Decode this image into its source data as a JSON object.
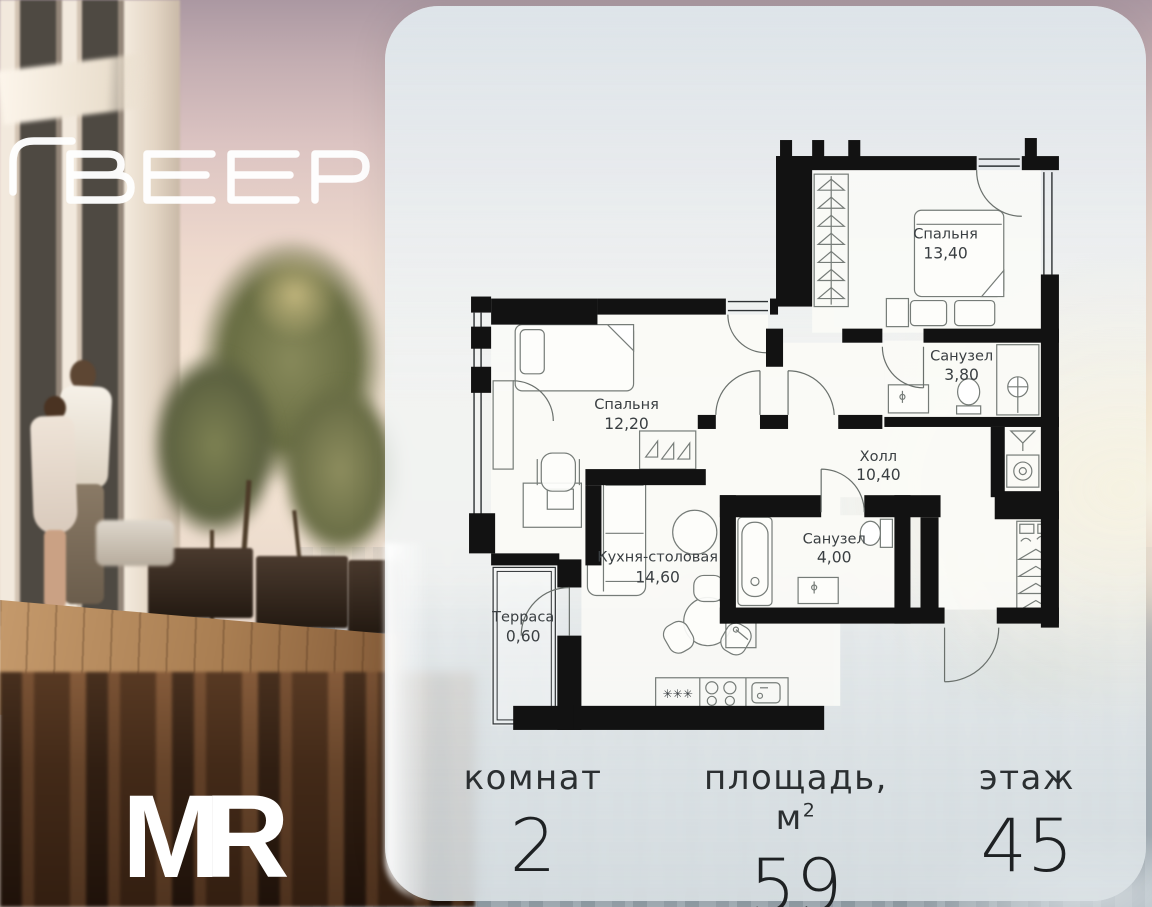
{
  "branding": {
    "project_logo": "ВЕЕР",
    "developer_logo": "MR"
  },
  "floorplan": {
    "rooms": [
      {
        "name": "Спальня",
        "area": "13,40"
      },
      {
        "name": "Санузел",
        "area": "3,80"
      },
      {
        "name": "Спальня",
        "area": "12,20"
      },
      {
        "name": "Холл",
        "area": "10,40"
      },
      {
        "name": "Кухня-столовая",
        "area": "14,60"
      },
      {
        "name": "Санузел",
        "area": "4,00"
      },
      {
        "name": "Терраса",
        "area": "0,60"
      }
    ],
    "symbols": {
      "knobs": "✳✳✳"
    }
  },
  "stats": {
    "rooms": {
      "label": "комнат",
      "value": "2"
    },
    "area": {
      "label": "площадь, м",
      "sup": "2",
      "value": "59"
    },
    "floor": {
      "label": "этаж",
      "value": "45"
    }
  },
  "colors": {
    "wall": "#121212",
    "card": "#f1f5f7",
    "sun_glow": "#f8eed2",
    "sky_top": "#ab98a2"
  }
}
